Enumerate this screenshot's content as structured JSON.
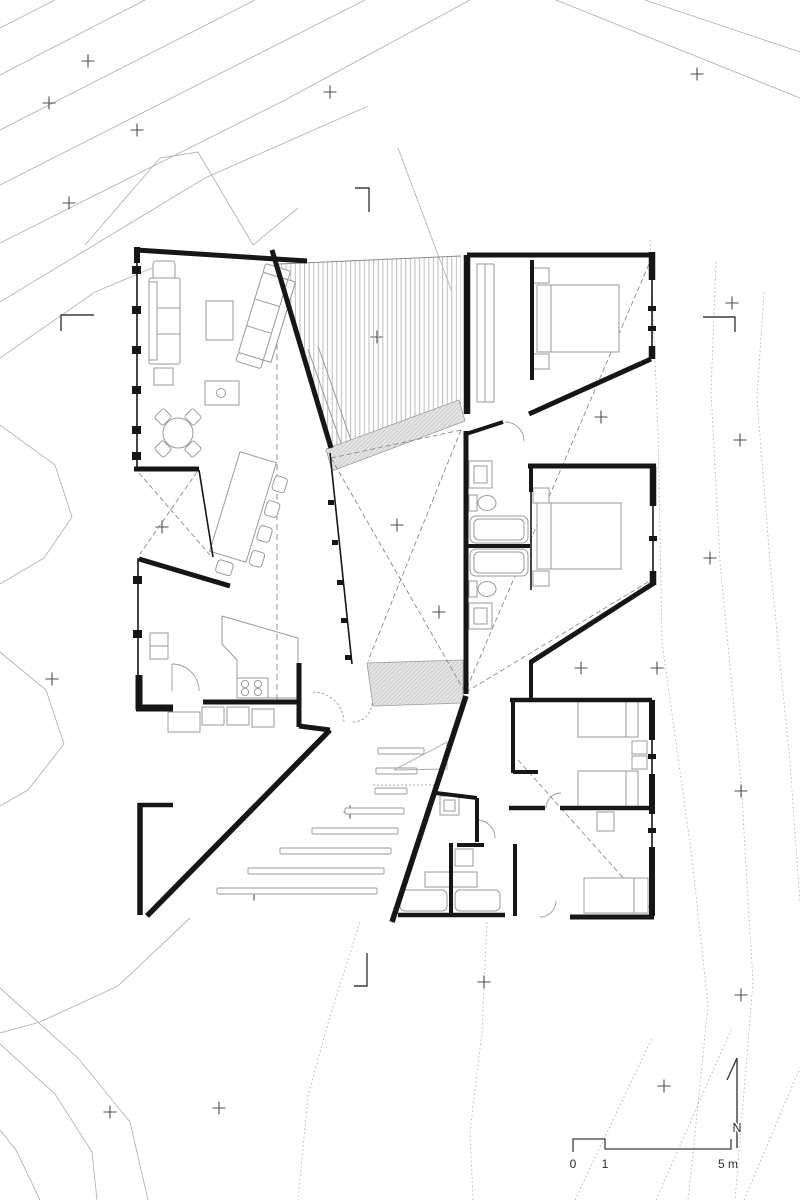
{
  "labels": {
    "north": "N",
    "scale_0": "0",
    "scale_1": "1",
    "scale_5m": "5 m"
  },
  "colors": {
    "background": "#ffffff",
    "walls": "#161616",
    "furniture": "#9a9a9a",
    "contour": "#b4b4b4",
    "survey_mark": "#4d4d4d",
    "deck_hatch": "#bdbdbd",
    "ramp_fill": "#e3e3e3",
    "dashed_lines": "#8a8a8a"
  },
  "icons": [
    "north-arrow-icon",
    "scale-bar-icon",
    "survey-cross-icon",
    "section-mark-icon"
  ],
  "survey_crosses": [
    [
      88,
      61
    ],
    [
      49,
      103
    ],
    [
      137,
      130
    ],
    [
      69,
      203
    ],
    [
      330,
      92
    ],
    [
      697,
      74
    ],
    [
      732,
      303
    ],
    [
      377,
      337
    ],
    [
      601,
      417
    ],
    [
      740,
      440
    ],
    [
      162,
      527
    ],
    [
      397,
      525
    ],
    [
      710,
      558
    ],
    [
      439,
      612
    ],
    [
      581,
      668
    ],
    [
      657,
      668
    ],
    [
      52,
      679
    ],
    [
      350,
      812
    ],
    [
      254,
      894
    ],
    [
      741,
      791
    ],
    [
      484,
      982
    ],
    [
      741,
      995
    ],
    [
      664,
      1086
    ],
    [
      219,
      1108
    ],
    [
      110,
      1112
    ]
  ],
  "contours": {
    "solid": [
      [
        [
          0,
          28
        ],
        [
          55,
          0
        ]
      ],
      [
        [
          0,
          75
        ],
        [
          145,
          0
        ]
      ],
      [
        [
          0,
          130
        ],
        [
          255,
          0
        ]
      ],
      [
        [
          0,
          185
        ],
        [
          365,
          0
        ]
      ],
      [
        [
          0,
          243
        ],
        [
          285,
          100
        ],
        [
          470,
          0
        ]
      ],
      [
        [
          0,
          302
        ],
        [
          205,
          178
        ],
        [
          368,
          106
        ]
      ],
      [
        [
          0,
          358
        ],
        [
          95,
          292
        ],
        [
          152,
          268
        ]
      ],
      [
        [
          85,
          245
        ],
        [
          160,
          158
        ],
        [
          198,
          152
        ],
        [
          253,
          245
        ]
      ],
      [
        [
          398,
          148
        ],
        [
          452,
          292
        ]
      ],
      [
        [
          253,
          245
        ],
        [
          298,
          208
        ]
      ],
      [
        [
          556,
          0
        ],
        [
          800,
          98
        ]
      ],
      [
        [
          645,
          0
        ],
        [
          800,
          52
        ]
      ],
      [
        [
          0,
          425
        ],
        [
          55,
          465
        ],
        [
          72,
          517
        ],
        [
          44,
          558
        ],
        [
          0,
          584
        ]
      ],
      [
        [
          0,
          652
        ],
        [
          46,
          690
        ],
        [
          64,
          744
        ],
        [
          28,
          790
        ],
        [
          0,
          806
        ]
      ],
      [
        [
          190,
          918
        ],
        [
          118,
          986
        ],
        [
          40,
          1022
        ],
        [
          0,
          1033
        ]
      ],
      [
        [
          0,
          988
        ],
        [
          78,
          1058
        ],
        [
          130,
          1122
        ],
        [
          148,
          1200
        ]
      ],
      [
        [
          0,
          1044
        ],
        [
          55,
          1094
        ],
        [
          92,
          1152
        ],
        [
          97,
          1200
        ]
      ],
      [
        [
          40,
          1200
        ],
        [
          16,
          1150
        ],
        [
          0,
          1130
        ]
      ]
    ],
    "dotted": [
      [
        [
          650,
          240
        ],
        [
          658,
          432
        ],
        [
          662,
          642
        ],
        [
          692,
          858
        ],
        [
          708,
          1005
        ],
        [
          698,
          1105
        ],
        [
          688,
          1200
        ]
      ],
      [
        [
          716,
          262
        ],
        [
          711,
          392
        ],
        [
          720,
          562
        ],
        [
          741,
          782
        ],
        [
          753,
          982
        ],
        [
          739,
          1152
        ],
        [
          735,
          1200
        ]
      ],
      [
        [
          764,
          292
        ],
        [
          757,
          398
        ],
        [
          770,
          562
        ],
        [
          790,
          762
        ],
        [
          800,
          902
        ]
      ],
      [
        [
          575,
          1200
        ],
        [
          652,
          1038
        ]
      ],
      [
        [
          656,
          1200
        ],
        [
          731,
          1030
        ]
      ],
      [
        [
          744,
          1200
        ],
        [
          800,
          1068
        ]
      ],
      [
        [
          360,
          922
        ],
        [
          330,
          1016
        ],
        [
          308,
          1096
        ],
        [
          298,
          1200
        ]
      ],
      [
        [
          487,
          922
        ],
        [
          482,
          1032
        ],
        [
          470,
          1132
        ],
        [
          473,
          1200
        ]
      ]
    ]
  },
  "terrace_steps": [
    [
      748,
      378,
      424
    ],
    [
      768,
      376,
      417
    ],
    [
      788,
      375,
      407
    ],
    [
      808,
      345,
      404
    ],
    [
      828,
      312,
      398
    ],
    [
      848,
      280,
      391
    ],
    [
      868,
      248,
      384
    ],
    [
      888,
      217,
      377
    ]
  ]
}
